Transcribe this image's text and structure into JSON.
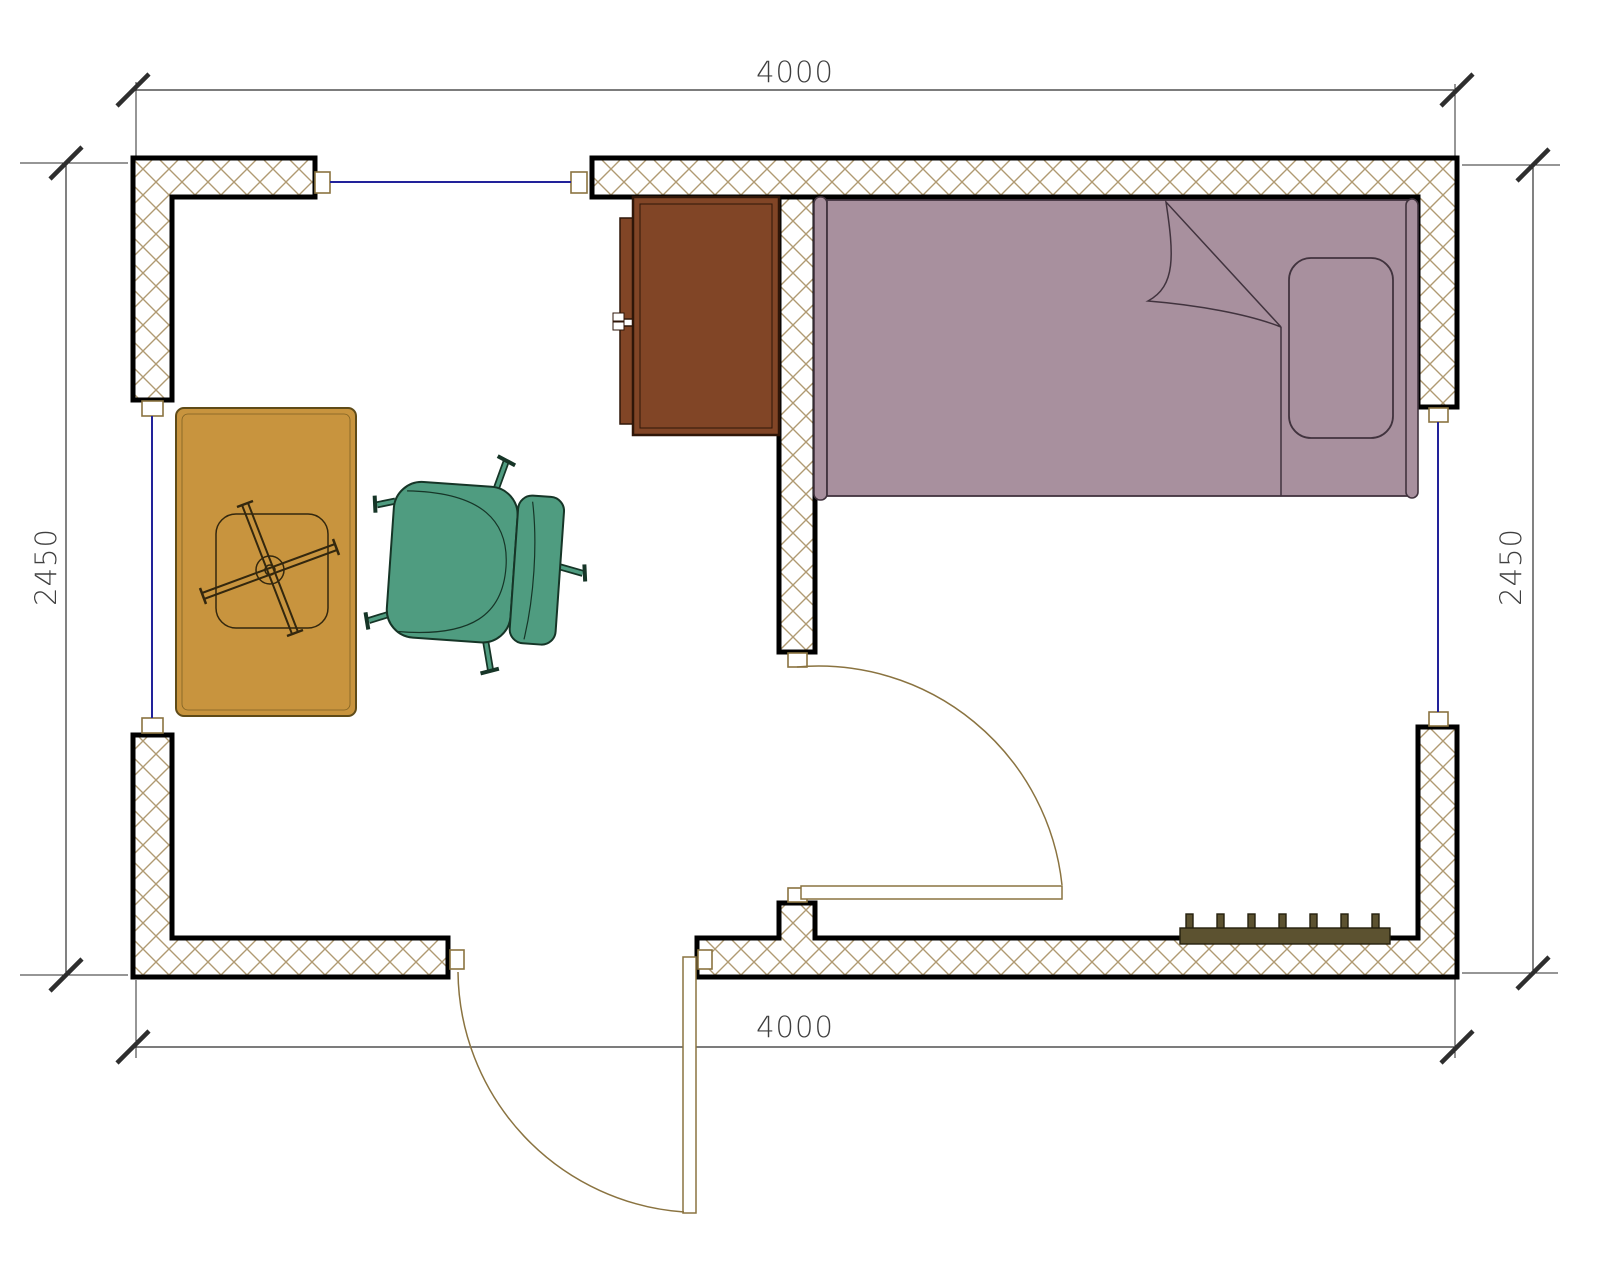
{
  "document": {
    "type": "room-floor-plan",
    "background": "#ffffff"
  },
  "dimensions": {
    "top": {
      "value": "4000",
      "orientation": "horizontal"
    },
    "bottom": {
      "value": "4000",
      "orientation": "horizontal"
    },
    "left": {
      "value": "2450",
      "orientation": "vertical"
    },
    "right": {
      "value": "2450",
      "orientation": "vertical"
    }
  },
  "objects": {
    "bed": {
      "name": "single-bed"
    },
    "wardrobe": {
      "name": "wardrobe-cabinet"
    },
    "table": {
      "name": "table-with-cross-base"
    },
    "chair": {
      "name": "office-chair"
    },
    "radiator": {
      "name": "radiator"
    },
    "doors": {
      "count": "2"
    },
    "windows": {
      "count": "3"
    }
  },
  "colors": {
    "hatch": "#b09a72",
    "wall_outline": "#000000",
    "window": "#22229a",
    "door": "#8a7340",
    "dimension": "#2e2e2e",
    "bed": "#a8909e",
    "bed_outline": "#41333e",
    "wardrobe": "#814526",
    "wardrobe_outline": "#2f1608",
    "table": "#c8943e",
    "table_outline": "#5f4b18",
    "table_detail": "#33270e",
    "chair": "#4f9c80",
    "chair_outline": "#163527",
    "radiator": "#5c5230",
    "radiator_outline": "#241f0d"
  }
}
